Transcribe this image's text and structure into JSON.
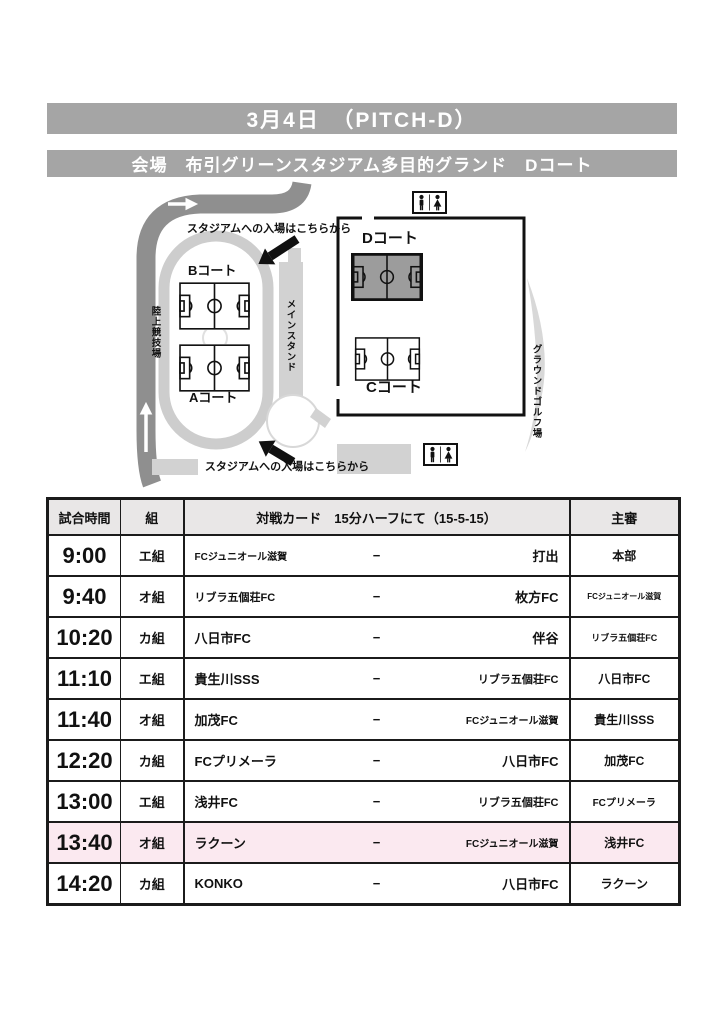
{
  "header": {
    "date_title": "3月4日　（PITCH-D）",
    "venue": "会場　布引グリーンスタジアム多目的グランド　Dコート"
  },
  "map": {
    "courts": {
      "a": "Aコート",
      "b": "Bコート",
      "c": "Cコート",
      "d": "Dコート"
    },
    "labels": {
      "track": "陸上競技場",
      "main_stand": "メインスタンド",
      "ground_golf": "グラウンドゴルフ場",
      "entrance_top": "スタジアムへの入場はこちらから",
      "entrance_bottom": "スタジアムへの入場はこちらから"
    },
    "icons": [
      "restroom-icon",
      "restroom-icon",
      "entrance-arrow",
      "entrance-arrow"
    ]
  },
  "schedule": {
    "headers": {
      "time": "試合時間",
      "group": "組",
      "match": "対戦カード　15分ハーフにて（15-5-15）",
      "referee": "主審"
    },
    "rows": [
      {
        "time": "9:00",
        "group": "エ組",
        "home": "FCジュニオール滋賀",
        "vs": "−",
        "away": "打出",
        "referee": "本部",
        "highlight": false
      },
      {
        "time": "9:40",
        "group": "オ組",
        "home": "リブラ五個荘FC",
        "vs": "−",
        "away": "枚方FC",
        "referee": "FCジュニオール滋賀",
        "highlight": false
      },
      {
        "time": "10:20",
        "group": "カ組",
        "home": "八日市FC",
        "vs": "−",
        "away": "伴谷",
        "referee": "リブラ五個荘FC",
        "highlight": false
      },
      {
        "time": "11:10",
        "group": "エ組",
        "home": "貴生川SSS",
        "vs": "−",
        "away": "リブラ五個荘FC",
        "referee": "八日市FC",
        "highlight": false
      },
      {
        "time": "11:40",
        "group": "オ組",
        "home": "加茂FC",
        "vs": "−",
        "away": "FCジュニオール滋賀",
        "referee": "貴生川SSS",
        "highlight": false
      },
      {
        "time": "12:20",
        "group": "カ組",
        "home": "FCプリメーラ",
        "vs": "−",
        "away": "八日市FC",
        "referee": "加茂FC",
        "highlight": false
      },
      {
        "time": "13:00",
        "group": "エ組",
        "home": "浅井FC",
        "vs": "−",
        "away": "リブラ五個荘FC",
        "referee": "FCプリメーラ",
        "highlight": false
      },
      {
        "time": "13:40",
        "group": "オ組",
        "home": "ラクーン",
        "vs": "−",
        "away": "FCジュニオール滋賀",
        "referee": "浅井FC",
        "highlight": true
      },
      {
        "time": "14:20",
        "group": "カ組",
        "home": "KONKO",
        "vs": "−",
        "away": "八日市FC",
        "referee": "ラクーン",
        "highlight": false
      }
    ]
  },
  "colors": {
    "bar_gray": "#a5a5a5",
    "header_gray": "#e9e7e7",
    "highlight_pink": "#fbe9f0",
    "field_gray": "#9c9c9c",
    "road_gray": "#8f8f8f"
  }
}
